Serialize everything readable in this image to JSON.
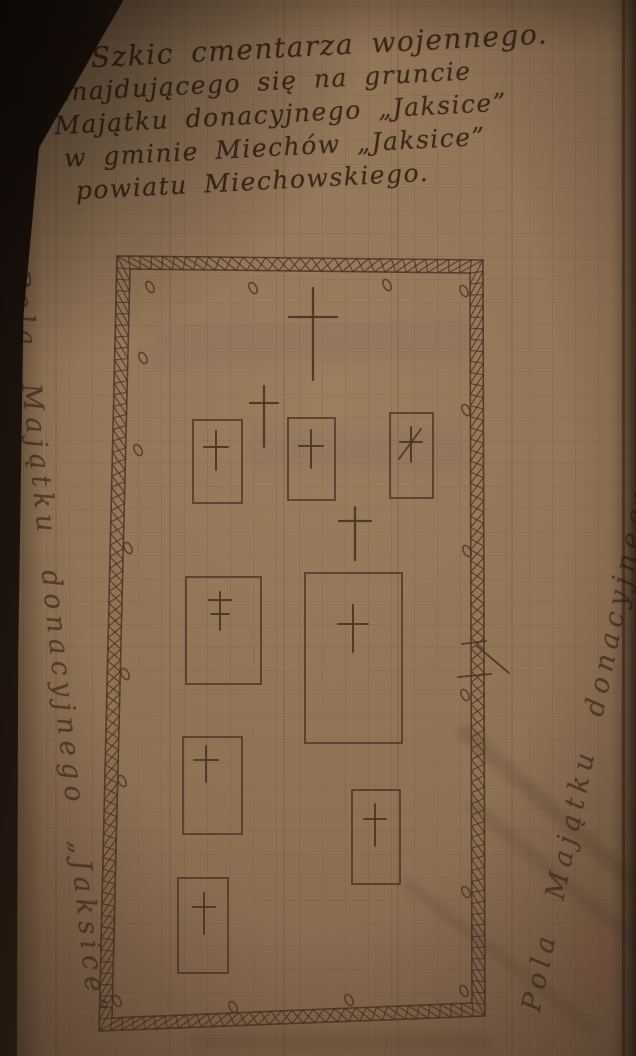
{
  "colors": {
    "paper": "#8f7254",
    "paper_shadow": "#66503a",
    "page_edge_dark": "#1c120b",
    "ink_title": "#3a291b",
    "ink_plan": "#4b3424"
  },
  "title": {
    "lines": [
      "Szkic cmentarza wojennego.",
      "znajdującego się na gruncie",
      "Majątku donacyjnego „Jaksice”",
      "w gminie Miechów „Jaksice”",
      "powiatu Miechowskiego."
    ]
  },
  "margin_labels": {
    "left": "Pola Majątku donacyjnego „Jaksice”",
    "right": "Pola Majątku donacyjnego „Jaksice”"
  },
  "sketch": {
    "border": {
      "outer": [
        [
          117,
          256
        ],
        [
          483,
          260
        ],
        [
          485,
          1016
        ],
        [
          99,
          1031
        ]
      ],
      "inner": [
        [
          130,
          269
        ],
        [
          470,
          273
        ],
        [
          472,
          1003
        ],
        [
          112,
          1018
        ]
      ],
      "x_step": 11.5
    },
    "crosses": [
      {
        "cx": 313,
        "top": 288,
        "bottom": 380,
        "bar_y": 317,
        "half": 24
      },
      {
        "cx": 264,
        "top": 386,
        "bottom": 447,
        "bar_y": 403,
        "half": 14
      },
      {
        "cx": 355,
        "top": 507,
        "bottom": 560,
        "bar_y": 521,
        "half": 16
      }
    ],
    "graves": [
      {
        "rect": [
          193,
          420,
          49,
          83
        ],
        "cross": {
          "cx": 216,
          "top": 431,
          "bottom": 470,
          "bar_y": 447,
          "half": 12
        }
      },
      {
        "rect": [
          288,
          418,
          47,
          82
        ],
        "cross": {
          "cx": 311,
          "top": 430,
          "bottom": 468,
          "bar_y": 446,
          "half": 12
        }
      },
      {
        "rect": [
          390,
          413,
          43,
          85
        ],
        "cross": {
          "cx": 411,
          "top": 427,
          "bottom": 462,
          "bar_y": 442,
          "half": 11
        },
        "slash": [
          399,
          459,
          421,
          429
        ]
      },
      {
        "rect": [
          186,
          577,
          75,
          107
        ],
        "cross": {
          "cx": 220,
          "top": 592,
          "bottom": 630,
          "bar_y": 600,
          "half": 11,
          "bar2_y": 614
        }
      },
      {
        "rect": [
          305,
          573,
          97,
          170
        ],
        "cross": {
          "cx": 353,
          "top": 605,
          "bottom": 652,
          "bar_y": 624,
          "half": 15
        }
      },
      {
        "rect": [
          183,
          737,
          59,
          97
        ],
        "cross": {
          "cx": 206,
          "top": 746,
          "bottom": 782,
          "bar_y": 760,
          "half": 12
        }
      },
      {
        "rect": [
          352,
          790,
          48,
          94
        ],
        "cross": {
          "cx": 375,
          "top": 804,
          "bottom": 846,
          "bar_y": 819,
          "half": 11
        }
      },
      {
        "rect": [
          178,
          878,
          50,
          95
        ],
        "cross": {
          "cx": 204,
          "top": 893,
          "bottom": 934,
          "bar_y": 907,
          "half": 11
        }
      }
    ],
    "gate_marks": [
      [
        462,
        644,
        486,
        641
      ],
      [
        458,
        677,
        491,
        674
      ],
      [
        477,
        646,
        509,
        673
      ]
    ],
    "o_marks": [
      [
        150,
        287
      ],
      [
        253,
        288
      ],
      [
        387,
        285
      ],
      [
        464,
        291
      ],
      [
        143,
        358
      ],
      [
        138,
        450
      ],
      [
        128,
        548
      ],
      [
        125,
        674
      ],
      [
        122,
        781
      ],
      [
        466,
        410
      ],
      [
        467,
        551
      ],
      [
        465,
        695
      ],
      [
        466,
        892
      ],
      [
        464,
        991
      ],
      [
        117,
        1001
      ],
      [
        233,
        1007
      ],
      [
        349,
        1000
      ]
    ]
  }
}
